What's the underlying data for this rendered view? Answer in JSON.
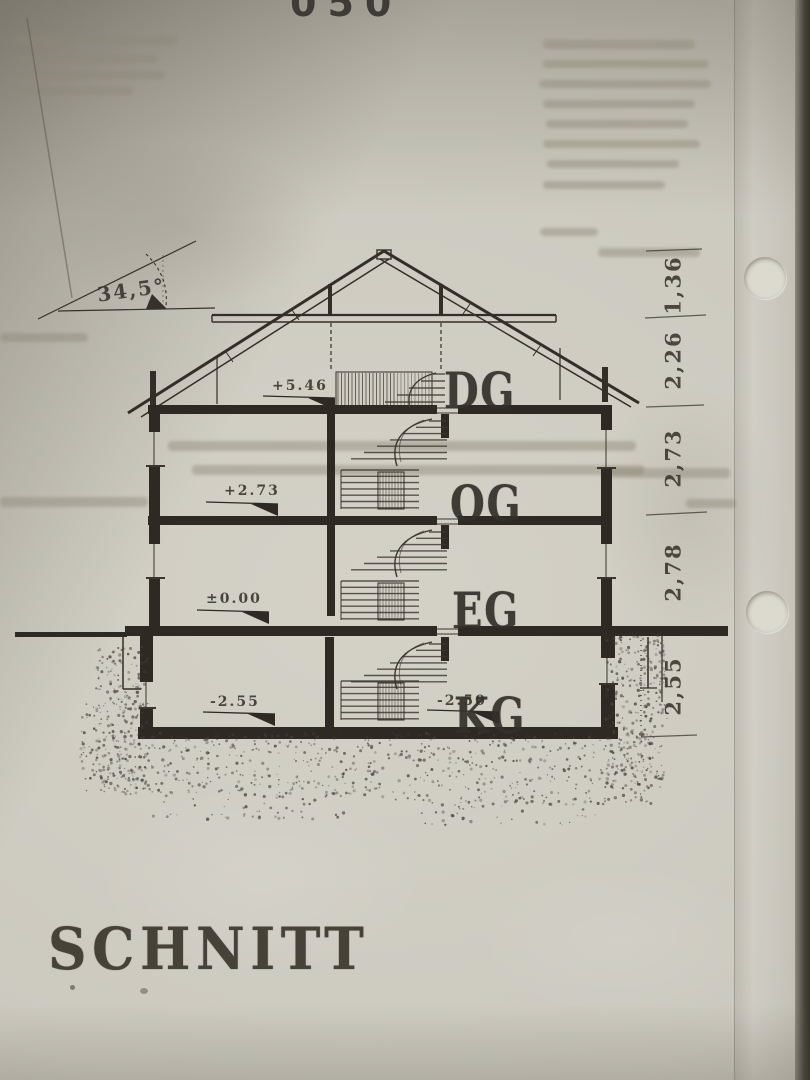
{
  "photo": {
    "top_edge_text": "050"
  },
  "drawing": {
    "angle_label": "34,5°",
    "floors": [
      {
        "label": "DG"
      },
      {
        "label": "OG"
      },
      {
        "label": "EG"
      },
      {
        "label": "KG"
      }
    ],
    "levels": [
      {
        "value": "+5.46"
      },
      {
        "value": "+2.73"
      },
      {
        "value": "±0.00"
      },
      {
        "value": "-2.55"
      },
      {
        "value": "-2.50"
      }
    ],
    "dimensions": [
      "1,36",
      "2,26",
      "2,73",
      "2,78",
      "2,55"
    ],
    "title": "SCHNITT"
  }
}
